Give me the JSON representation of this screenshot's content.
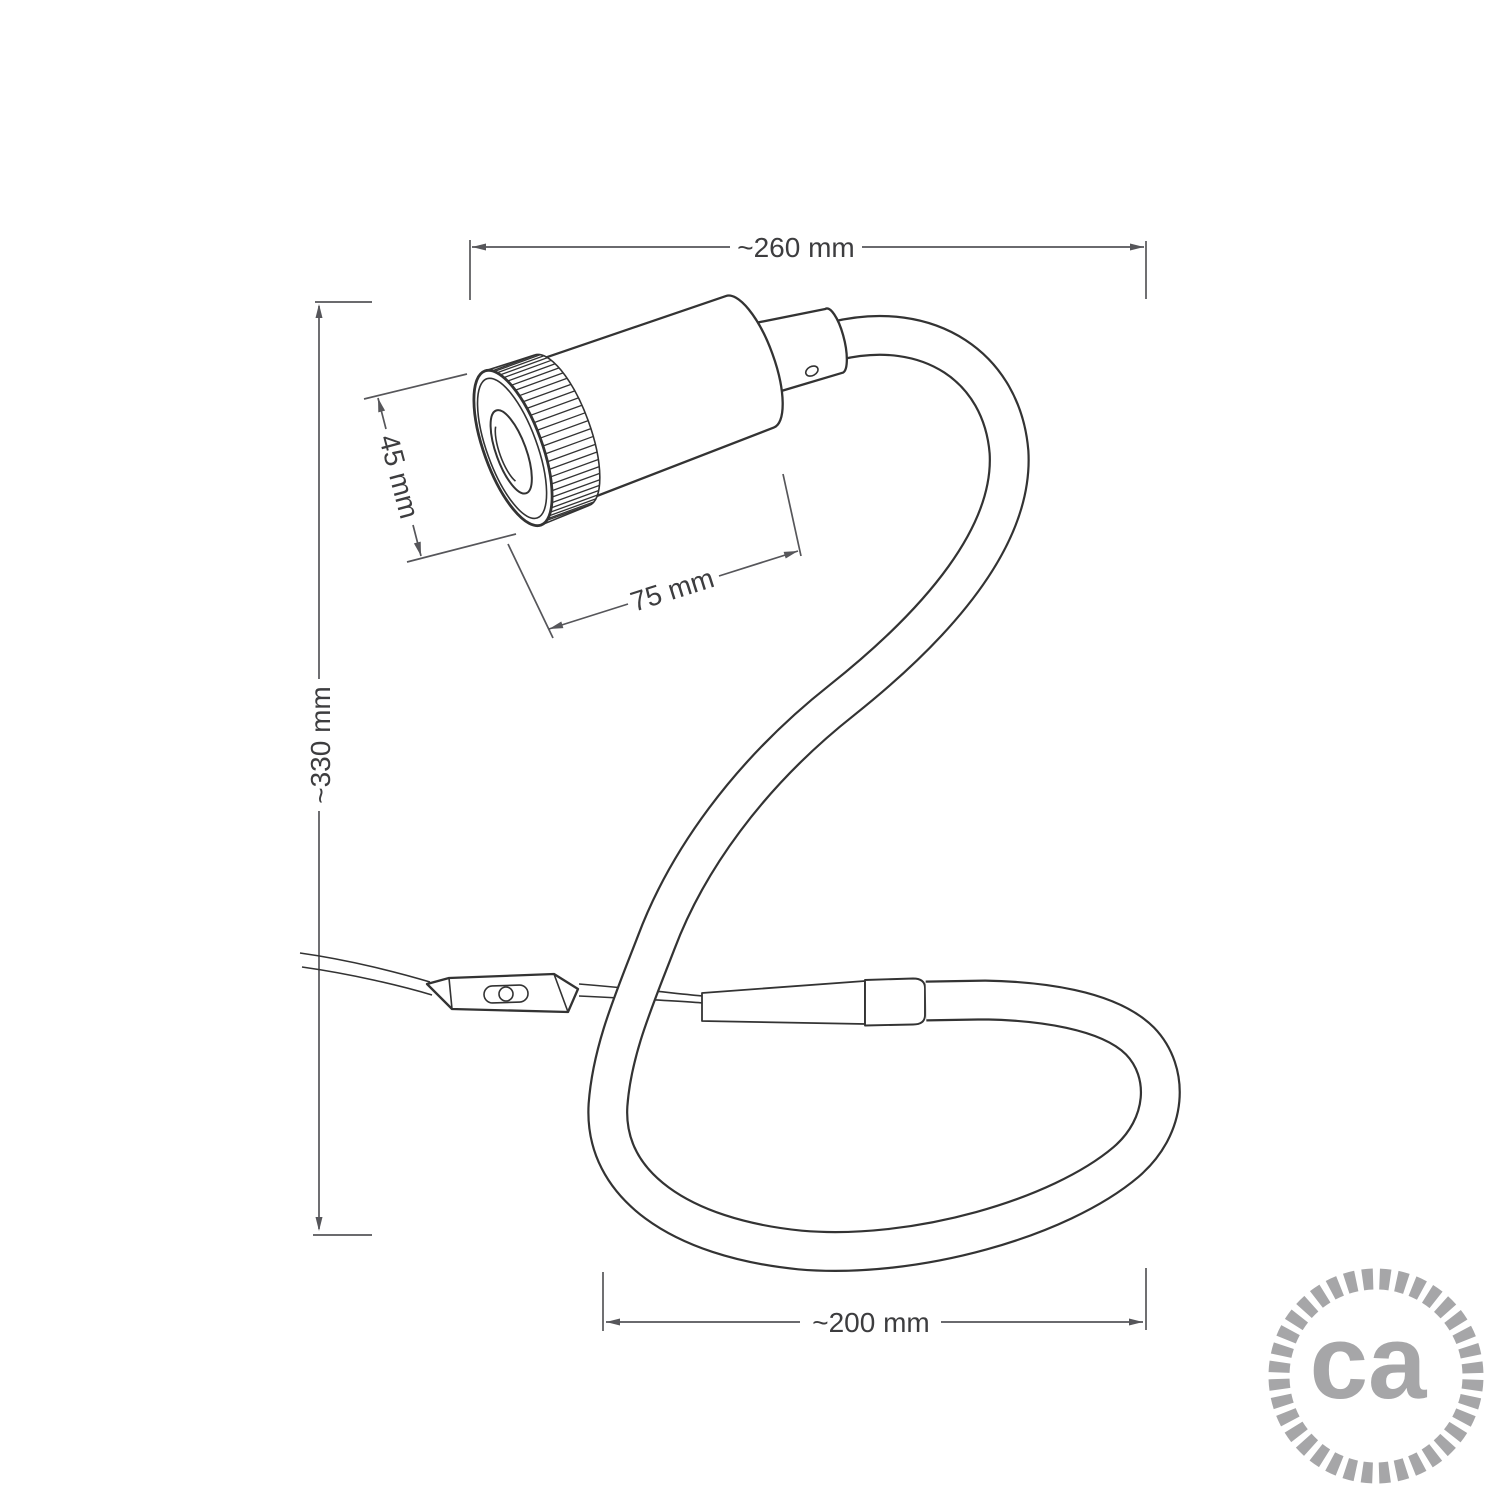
{
  "drawing": {
    "dimensions": {
      "top_width": "~260 mm",
      "left_height": "~330 mm",
      "head_diameter": "45 mm",
      "head_length": "75 mm",
      "bottom_width": "~200 mm"
    },
    "logo": {
      "text": "ca"
    },
    "colors": {
      "line": "#333333",
      "dimension": "#56565a",
      "text": "#3d3d3f",
      "logo": "#a6a6a8",
      "background": "#ffffff"
    }
  }
}
